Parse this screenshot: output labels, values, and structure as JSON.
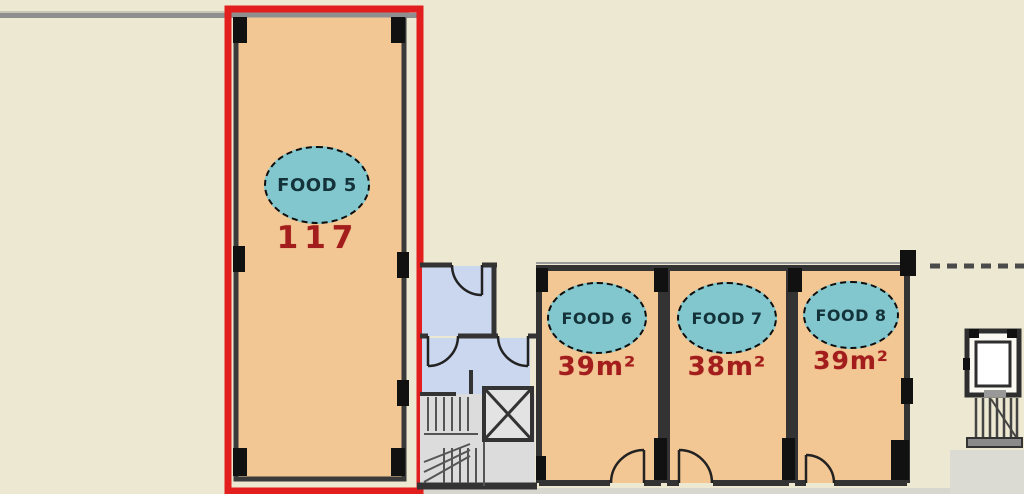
{
  "plan": {
    "type": "retail-floor-plan",
    "units": [
      {
        "id": "food-5",
        "label": "FOOD 5",
        "area": "117",
        "highlighted": true
      },
      {
        "id": "food-6",
        "label": "FOOD 6",
        "area": "39m²",
        "highlighted": false
      },
      {
        "id": "food-7",
        "label": "FOOD 7",
        "area": "38m²",
        "highlighted": false
      },
      {
        "id": "food-8",
        "label": "FOOD 8",
        "area": "39m²",
        "highlighted": false
      }
    ],
    "colors": {
      "background": "#EDE8D1",
      "unit_fill": "#F3C794",
      "badge_fill": "#82C7CE",
      "badge_text": "#14323A",
      "area_text": "#A31D1D",
      "highlight_border": "#E31E1E",
      "wall": "#333333",
      "exterior_wall_gray": "#8F8F8F",
      "corridor_fill": "#CBD7EF",
      "stairs_fill": "#DCDCDC"
    }
  }
}
